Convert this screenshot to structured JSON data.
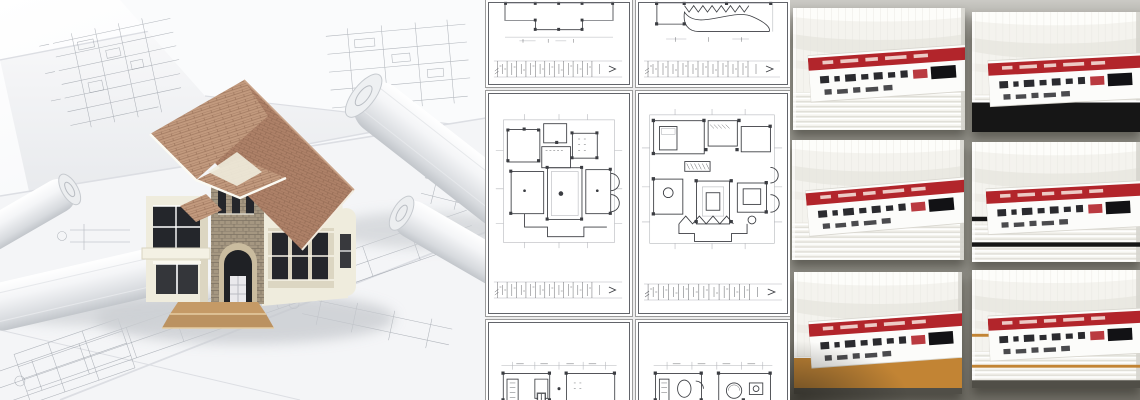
{
  "page": {
    "description": "Architectural collage: 3D house model on rolled blueprints, grid of floor plan sheets, and crown moulding product samples"
  },
  "left_panel": {
    "caption": "3D house model standing on architectural blueprint sheets with rolled-up drawings",
    "elements": [
      "blueprint-sheets",
      "blueprint-roll-left",
      "blueprint-roll-right",
      "house-model",
      "front-steps"
    ]
  },
  "middle_panel": {
    "caption": "Six architectural floor plan sheets arranged in a 2 by 3 grid",
    "grid": {
      "rows": 3,
      "cols": 2
    },
    "sheets": [
      {
        "id": "sheet-top-left",
        "content": "ceiling plan fragment with dimension strip"
      },
      {
        "id": "sheet-top-right",
        "content": "plan fragment with stair zigzag and curved terrace, dimension strip"
      },
      {
        "id": "sheet-mid-left",
        "content": "full floor plan with columns, door arcs and dimension strip"
      },
      {
        "id": "sheet-mid-right",
        "content": "furnished floor plan with deck zigzag and dimension strip"
      },
      {
        "id": "sheet-bottom-left",
        "content": "upper edge of kitchen floor plan, cut off"
      },
      {
        "id": "sheet-bottom-right",
        "content": "upper edge of furnished floor plan, cut off"
      }
    ]
  },
  "right_panel": {
    "caption": "Six white crown moulding samples with red product labels on grey background",
    "grid": {
      "rows": 3,
      "cols": 2
    },
    "samples": [
      {
        "id": "sample-top-left",
        "accent": "plain-white"
      },
      {
        "id": "sample-top-right",
        "accent": "black-band"
      },
      {
        "id": "sample-middle-left",
        "accent": "plain-white"
      },
      {
        "id": "sample-middle-right",
        "accent": "black-pinstripes"
      },
      {
        "id": "sample-bottom-left",
        "accent": "gold-band"
      },
      {
        "id": "sample-bottom-right",
        "accent": "gold-pinstripes"
      }
    ],
    "label": {
      "name": "product-label",
      "stripe": "red",
      "text": "illegible small print"
    }
  },
  "theme": {
    "paper": "#f6f6f8",
    "paper-edge": "#dcdee3",
    "draft-ink": "#8a9099",
    "roof": "#ae8168",
    "roof-light": "#c29a7e",
    "roof-line": "#8f6750",
    "wall": "#efecdd",
    "wall-shade": "#dcd6c2",
    "stone": "#a59781",
    "stone-dark": "#7d7263",
    "window-dark": "#24262b",
    "steps": "#bb9261",
    "plan-ink": "#3b3d42",
    "plan-grey": "#b3b5ba",
    "sheet-border": "#62646a",
    "divider": "#9c9c9c",
    "mould-bg": "#94938b",
    "mould-bg-light": "#cbcac5",
    "sample": "#f4f3ee",
    "ridge": "#dbdad3",
    "label-white": "#fcfcfa",
    "label-red": "#b2252b",
    "text-dark": "#2b2b2f",
    "black-band": "#161616",
    "gold": "#c28434",
    "deep-shadow": "#504e47"
  }
}
